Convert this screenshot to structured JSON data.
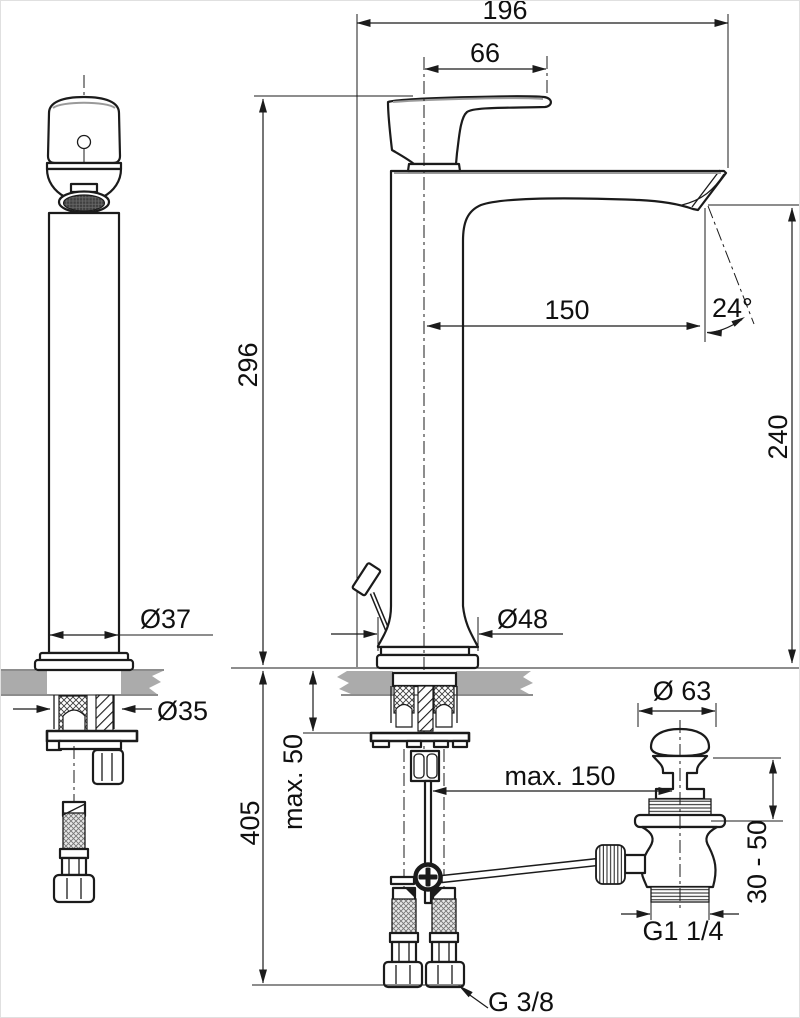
{
  "drawing": {
    "colors": {
      "line": "#1b1b1b",
      "deck_gray": "#ababab",
      "braid_base": "#e9e9e9",
      "braid_line": "#777777",
      "aerator_dark": "#3f3f3f"
    },
    "dimensions": {
      "overall_depth": "196",
      "handle_offset": "66",
      "height_above_deck": "296",
      "spout_reach": "150",
      "spray_angle": "24°",
      "spout_to_deck": "240",
      "body_diameter": "Ø37",
      "shank_diameter": "Ø35",
      "base_diameter": "Ø48",
      "deck_thickness_max": "max. 50",
      "height_below_total": "405",
      "rod_reach_max": "max. 150",
      "drain_cap_diameter": "Ø 63",
      "drain_deck_range": "30 - 50",
      "drain_thread": "G1 1/4",
      "supply_thread": "G 3/8"
    }
  }
}
